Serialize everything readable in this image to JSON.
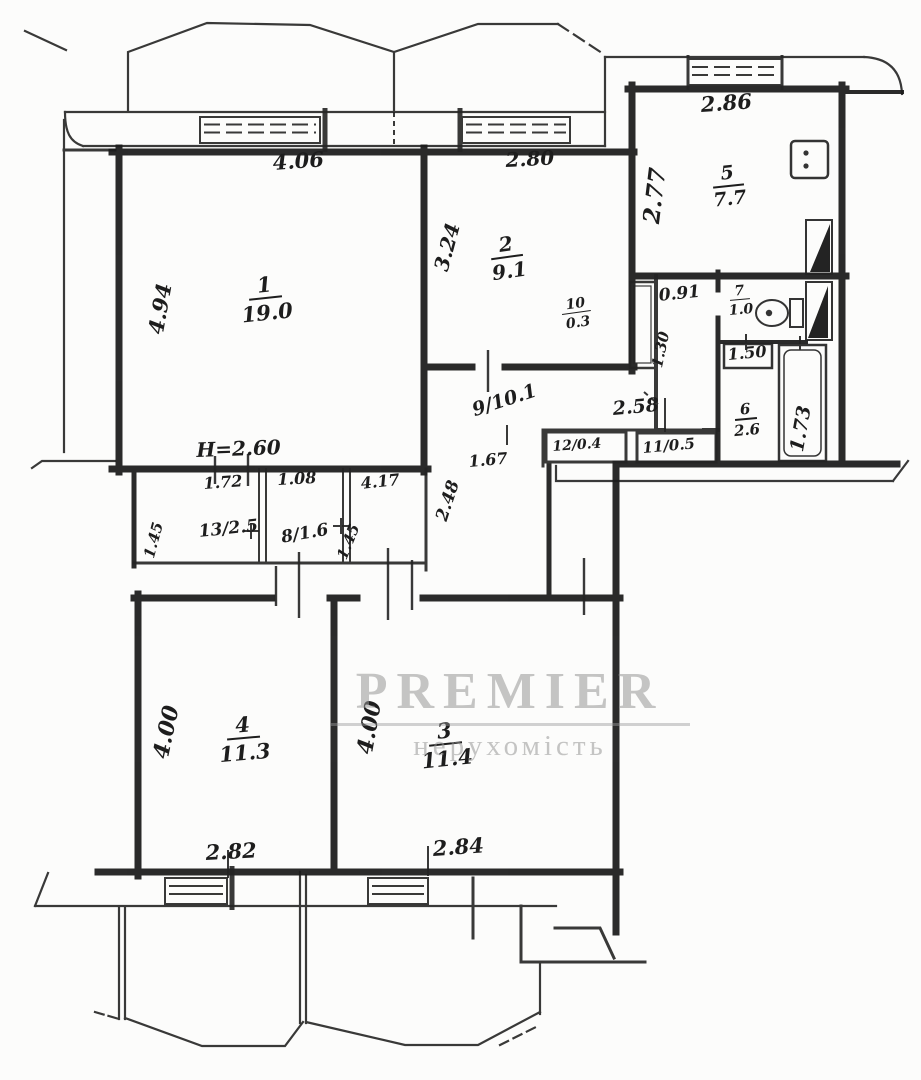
{
  "watermark": {
    "brand": "PREMIER",
    "subtitle": "нерухомість"
  },
  "colors": {
    "ink": "#1d1d1d",
    "paper": "#fcfcfb",
    "watermark": "#969696"
  },
  "rooms": {
    "room1": {
      "number": "1",
      "area": "19.0"
    },
    "room2": {
      "number": "2",
      "area": "9.1"
    },
    "room3": {
      "number": "3",
      "area": "11.4"
    },
    "room4": {
      "number": "4",
      "area": "11.3"
    },
    "room5": {
      "number": "5",
      "area": "7.7"
    },
    "room6": {
      "number": "6",
      "area": "2.6"
    },
    "room7": {
      "number": "7",
      "area": "1.0"
    },
    "room8": "8/1.6",
    "room9": "9/10.1",
    "room10": {
      "number": "10",
      "area": "0.3"
    },
    "closet11": "11/0.5",
    "closet12": "12/0.4",
    "closet13": "13/2.5"
  },
  "dimensions": {
    "room1_width": "4.06",
    "room1_depth": "4.94",
    "ceiling_height": "H=2.60",
    "room2_width": "2.80",
    "room2_depth": "3.24",
    "kitchen_width": "2.86",
    "kitchen_depth": "2.77",
    "vestibule_width": "0.91",
    "vestibule_depth": "1.30",
    "sink_width": "1.50",
    "tub_length": "1.73",
    "hall_width": "2.58",
    "hall_length": "1.67",
    "hall_diagonal": "2.48",
    "closet13_width": "1.72",
    "closet8_width": "1.08",
    "hall_lower_width": "4.17",
    "closet_depth_left": "1.45",
    "closet_depth_right": "1.45",
    "room4_depth": "4.00",
    "room4_width": "2.82",
    "room3_depth": "4.00",
    "room3_width": "2.84"
  }
}
